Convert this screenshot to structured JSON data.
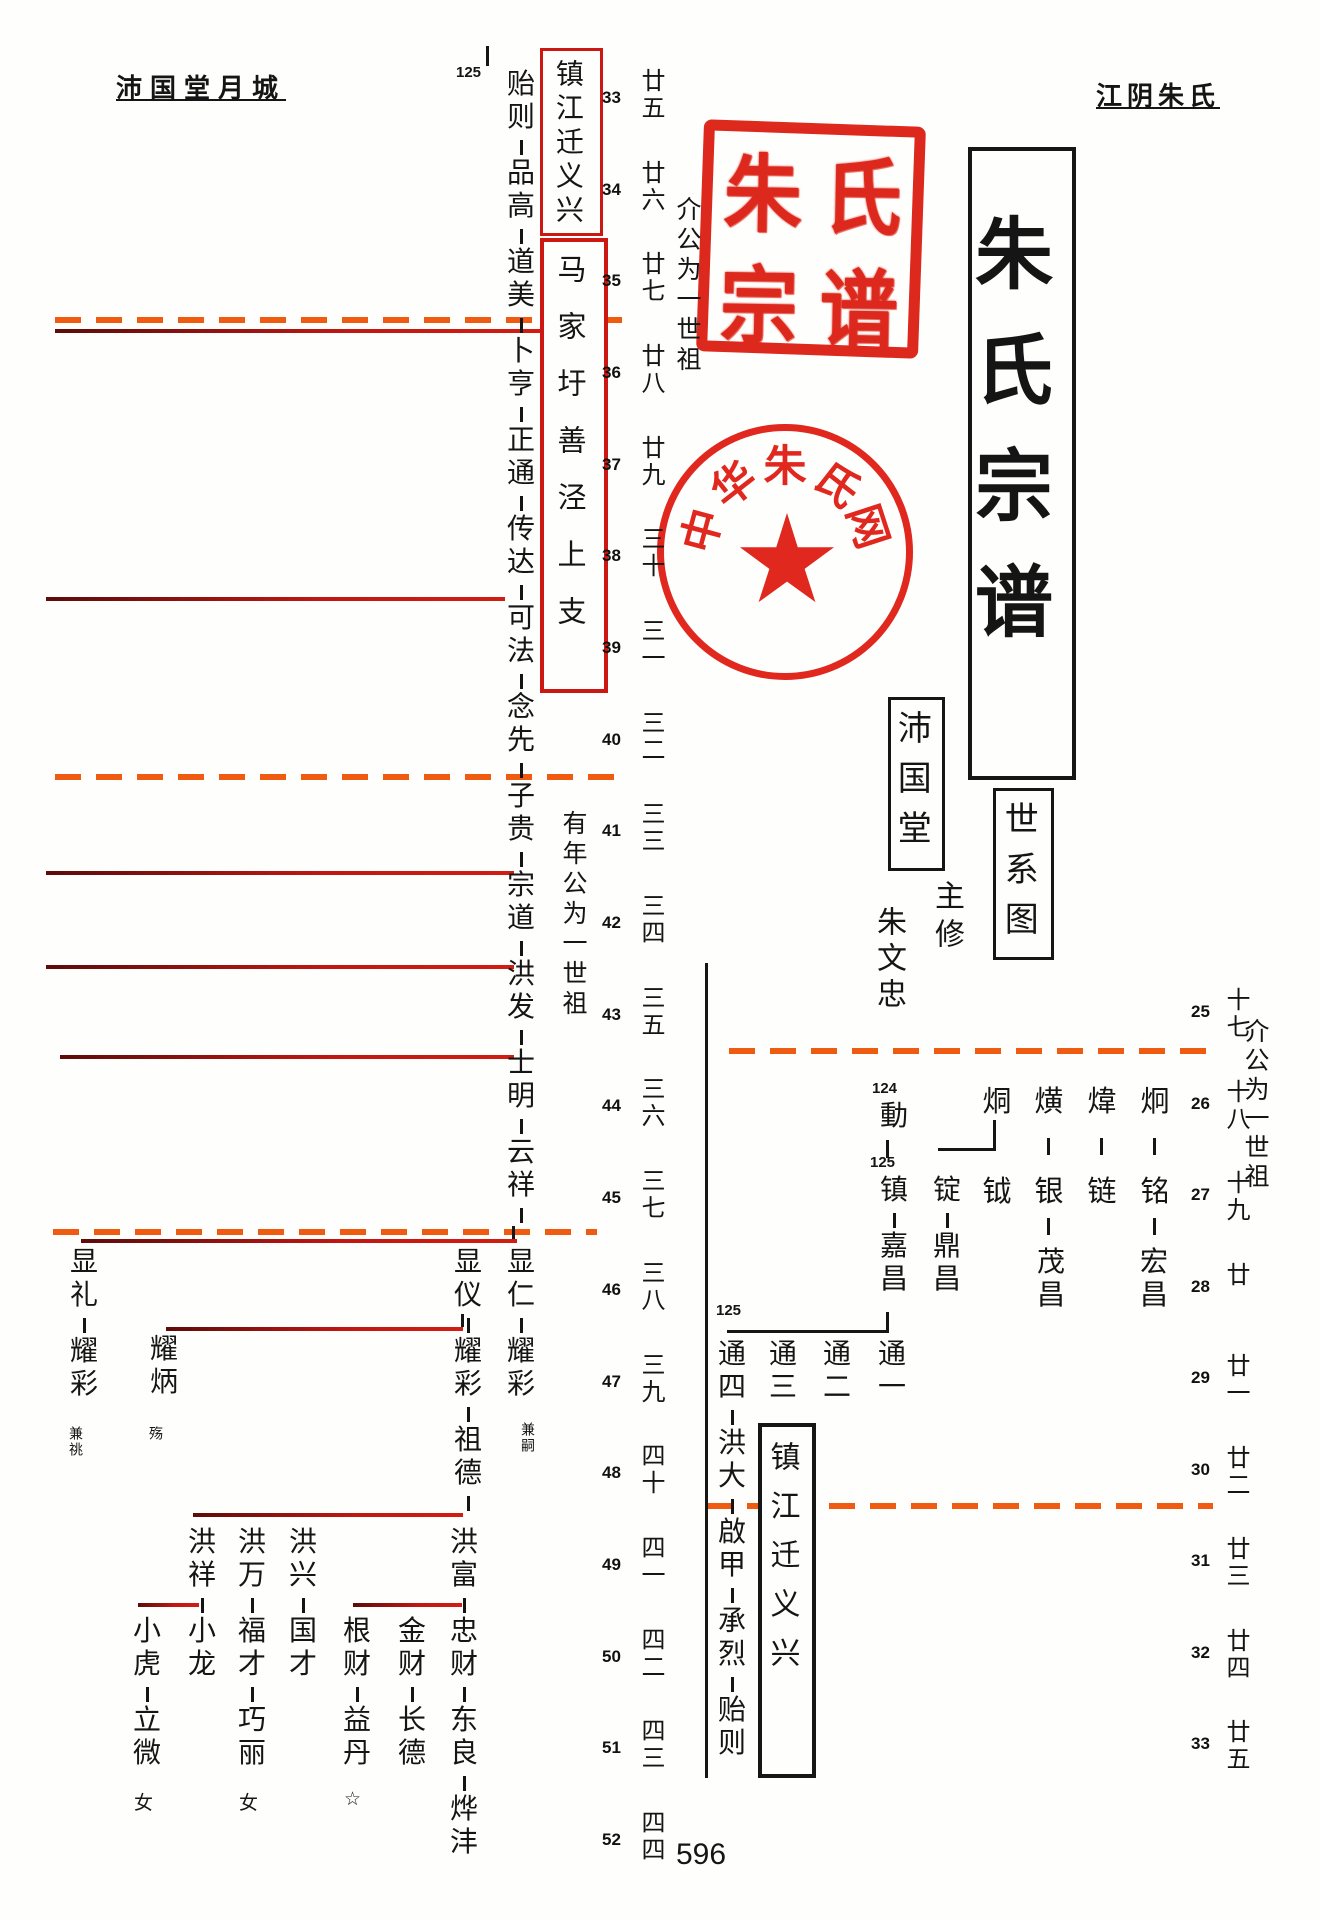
{
  "page": {
    "header_left": "沛国堂月城",
    "header_right": "江阴朱氏",
    "page_number": "596"
  },
  "boxes": {
    "top_red_branch": "镇江迁义兴",
    "mid_red_branch": "马家圩善泾上支",
    "title": "朱氏宗谱",
    "chart_label": "世系图",
    "hall": "沛国堂",
    "bottom_branch": "镇江迁义兴"
  },
  "annotations": {
    "ancestor_note_top": "介公为一世祖",
    "ancestor_note_mid": "有年公为一世祖",
    "ancestor_note_right": "介公为一世祖",
    "editor_title": "主修",
    "editor_name": "朱文忠",
    "ref_top": "125",
    "ref_124": "124",
    "ref_125_mid": "125",
    "ref_125_low": "125",
    "note_jiansi": "兼嗣",
    "note_jiantiao": "兼祧",
    "note_shang": "殇",
    "female_1": "女",
    "female_2": "女",
    "female_star": "☆"
  },
  "scales": {
    "left": [
      {
        "no": "33",
        "gen": "廿五"
      },
      {
        "no": "34",
        "gen": "廿六"
      },
      {
        "no": "35",
        "gen": "廿七"
      },
      {
        "no": "36",
        "gen": "廿八"
      },
      {
        "no": "37",
        "gen": "廿九"
      },
      {
        "no": "38",
        "gen": "三十"
      },
      {
        "no": "39",
        "gen": "三一"
      },
      {
        "no": "40",
        "gen": "三二"
      },
      {
        "no": "41",
        "gen": "三三"
      },
      {
        "no": "42",
        "gen": "三四"
      },
      {
        "no": "43",
        "gen": "三五"
      },
      {
        "no": "44",
        "gen": "三六"
      },
      {
        "no": "45",
        "gen": "三七"
      },
      {
        "no": "46",
        "gen": "三八"
      },
      {
        "no": "47",
        "gen": "三九"
      },
      {
        "no": "48",
        "gen": "四十"
      },
      {
        "no": "49",
        "gen": "四一"
      },
      {
        "no": "50",
        "gen": "四二"
      },
      {
        "no": "51",
        "gen": "四三"
      },
      {
        "no": "52",
        "gen": "四四"
      }
    ],
    "right": [
      {
        "no": "25",
        "gen": "十七"
      },
      {
        "no": "26",
        "gen": "十八"
      },
      {
        "no": "27",
        "gen": "十九"
      },
      {
        "no": "28",
        "gen": "廿"
      },
      {
        "no": "29",
        "gen": "廿一"
      },
      {
        "no": "30",
        "gen": "廿二"
      },
      {
        "no": "31",
        "gen": "廿三"
      },
      {
        "no": "32",
        "gen": "廿四"
      },
      {
        "no": "33",
        "gen": "廿五"
      }
    ]
  },
  "chains": {
    "main_left": "贻则-品高-道美-卜亨-正通-传达-可法-念先-子贵-宗道-洪发-士明-云祥-",
    "xianren": "显仁-耀彩",
    "xianyi": "显仪-耀彩-祖德-",
    "xianli": "显礼-耀彩",
    "yaobing": "耀炳",
    "hongxiang": "洪祥-",
    "xiaolong": "小龙",
    "xiaohu": "小虎-立微",
    "hongwan": "洪万-福才-巧丽",
    "hongxing": "洪兴-国才",
    "hongfu": "洪富-",
    "gencai": "根财-益丹",
    "jincai": "金财-长德",
    "zhongcai": "忠财-东良-烨沣",
    "dong": "動",
    "zhen": "镇-嘉昌",
    "ding": "锭-鼎昌",
    "maochang": "茂昌",
    "hongchang": "宏昌",
    "tong1": "通一",
    "tong2": "通二",
    "tong3": "通三",
    "tong4": "通四-洪大-啟甲-承烈-贻则"
  },
  "grid": {
    "row26": [
      "烔",
      "熿",
      "煒",
      "炯"
    ],
    "row27": [
      "钺",
      "银",
      "链",
      "铭"
    ]
  },
  "seals": {
    "square": {
      "chars": [
        "朱",
        "氏",
        "宗",
        "谱"
      ]
    },
    "circle": {
      "chars": [
        "中",
        "华",
        "朱",
        "氏",
        "网"
      ]
    }
  },
  "colors": {
    "red_line": "#c01712",
    "dash": "#ef5b10",
    "seal_red": "#dc2114",
    "red_box_border": "#cc1712"
  }
}
